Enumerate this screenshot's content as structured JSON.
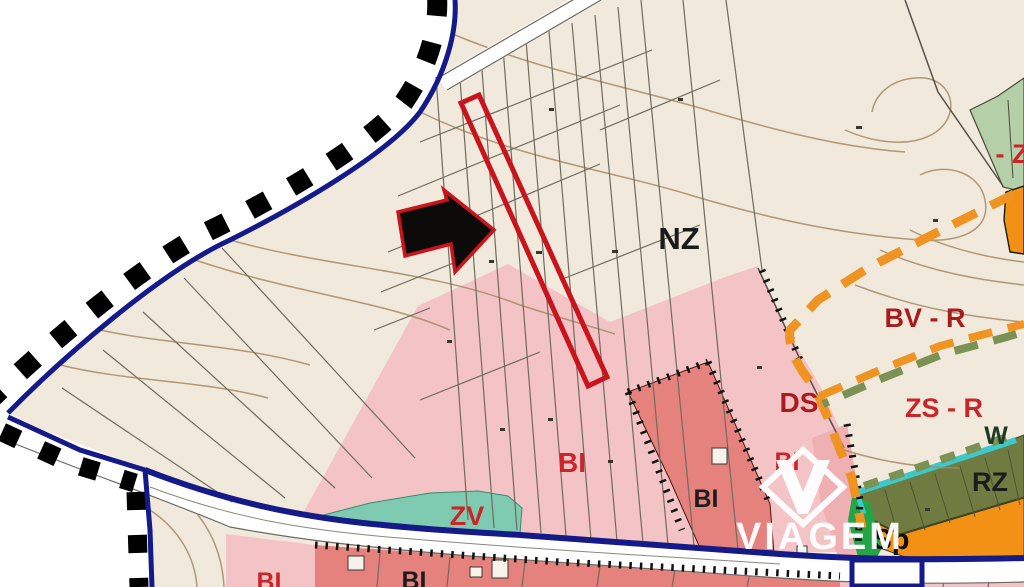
{
  "map": {
    "kind": "municipal-zoning-plan-detail",
    "labels": [
      {
        "id": "nz",
        "text": "NZ",
        "color": "#1b1b1b"
      },
      {
        "id": "z-edge",
        "text": "- Z",
        "color": "#c9252b"
      },
      {
        "id": "bv-r",
        "text": "BV - R",
        "color": "#a81c1f"
      },
      {
        "id": "zs-r",
        "text": "ZS - R",
        "color": "#c9252b"
      },
      {
        "id": "ds",
        "text": "DS",
        "color": "#a81c1f"
      },
      {
        "id": "bi-center",
        "text": "BI",
        "color": "#c9252b"
      },
      {
        "id": "bi-strip",
        "text": "BI",
        "color": "#c9252b"
      },
      {
        "id": "bi-dark",
        "text": "BI",
        "color": "#1b1b1b"
      },
      {
        "id": "zv",
        "text": "ZV",
        "color": "#c9252b"
      },
      {
        "id": "w",
        "text": "W",
        "color": "#1d3b24"
      },
      {
        "id": "rz",
        "text": "RZ",
        "color": "#1b1b1b"
      },
      {
        "id": "sp",
        "text": "Sp",
        "color": "#101010"
      },
      {
        "id": "bi-bl",
        "text": "BI",
        "color": "#c9252b"
      },
      {
        "id": "bi-bm",
        "text": "BI",
        "color": "#1b1b1b"
      }
    ],
    "watermark": {
      "text": "VIAGEM",
      "color": "#ffffff"
    },
    "highlight": {
      "parcel_outline_color": "#c8151d",
      "arrow_fill": "#0d0a0a",
      "arrow_outline": "#c8151d"
    },
    "zone_colors": {
      "outside": "#ffffff",
      "nz_cream": "#f1e9dc",
      "bi_pink_light": "#f4c3c5",
      "bi_pink_medium": "#efb0b4",
      "bi_red": "#e6827d",
      "zv_teal": "#7fcbb2",
      "z_light_green": "#b5cfa9",
      "rz_olive": "#6f7b40",
      "orange_zone": "#f39114",
      "w_cyan": "#3cc9cb",
      "green_strip": "#22a447"
    },
    "line_colors": {
      "municipal_boundary_blue": "#141a88",
      "municipal_boundary_dash": "#000000",
      "bv_r_dash_orange": "#ef9422",
      "zs_r_dash_green": "#7c9154",
      "contour_brown": "#a58a67",
      "parcel_gray": "#6f6b60"
    }
  }
}
